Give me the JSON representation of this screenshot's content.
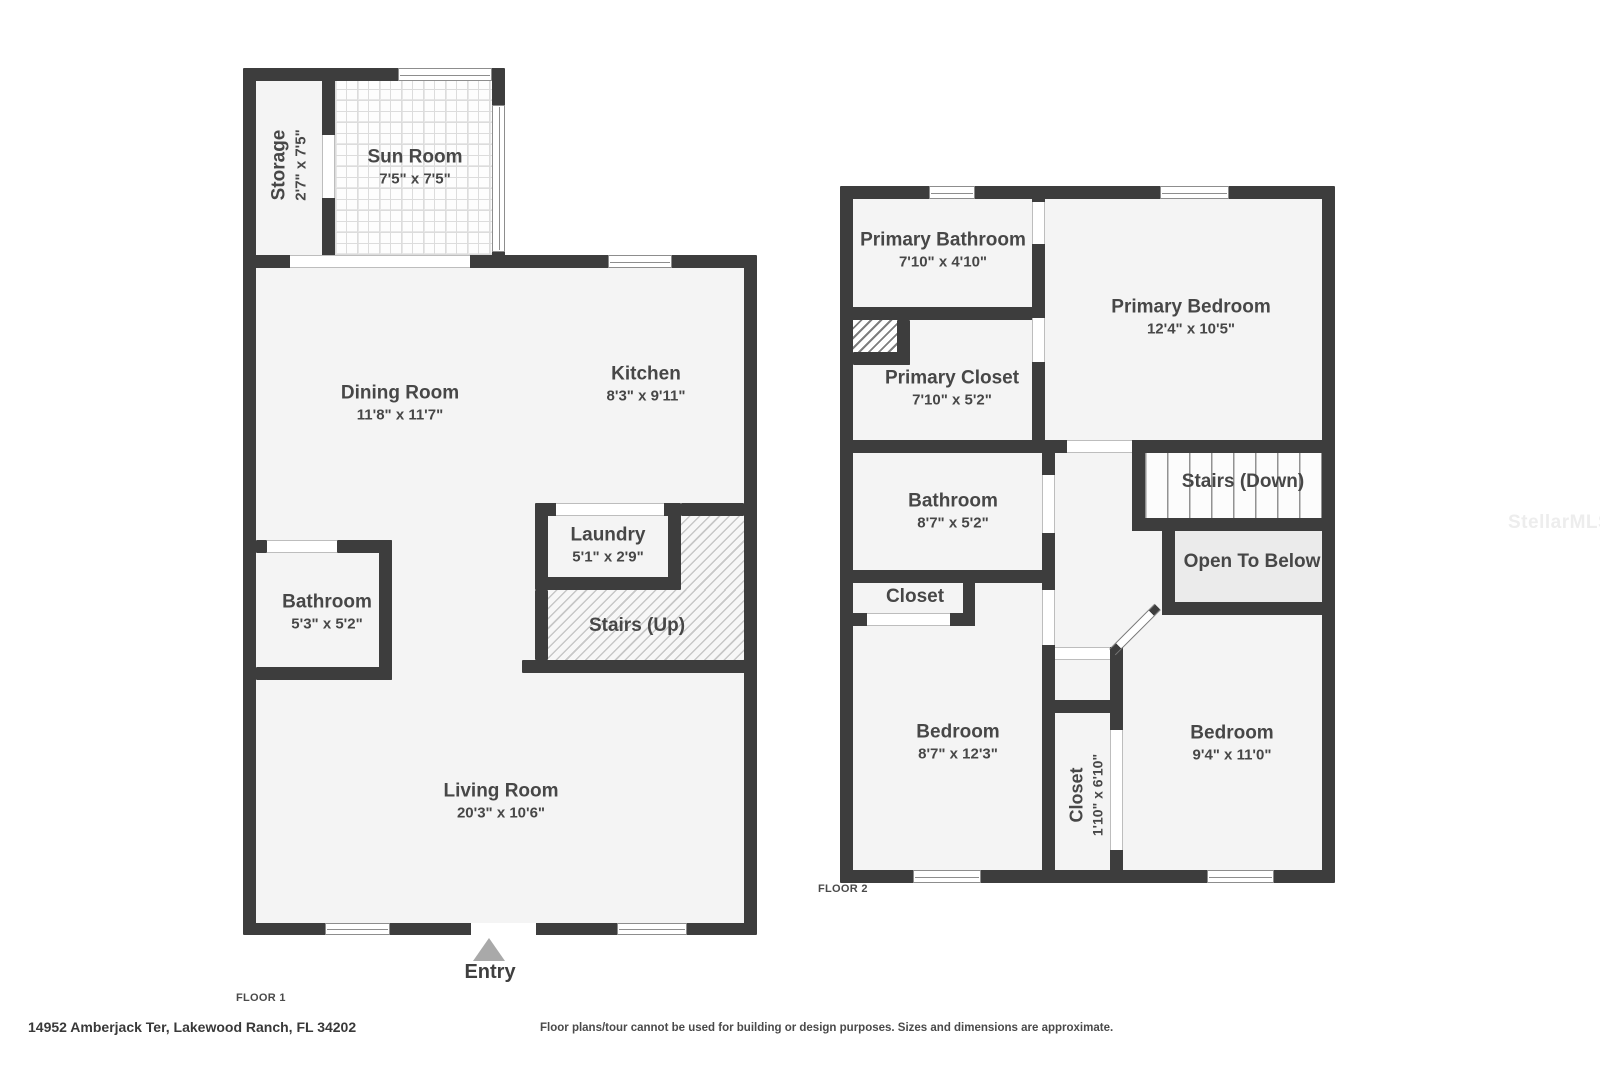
{
  "watermark": "StellarMLS",
  "footer": {
    "address": "14952 Amberjack Ter, Lakewood Ranch, FL 34202",
    "disclaimer": "Floor plans/tour cannot be used for building or design purposes. Sizes and dimensions are approximate."
  },
  "floor1": {
    "label": "FLOOR 1",
    "entry_label": "Entry",
    "rooms": {
      "storage": {
        "name": "Storage",
        "dims": "2'7\" x 7'5\""
      },
      "sun_room": {
        "name": "Sun Room",
        "dims": "7'5\" x 7'5\""
      },
      "dining_room": {
        "name": "Dining Room",
        "dims": "11'8\" x 11'7\""
      },
      "kitchen": {
        "name": "Kitchen",
        "dims": "8'3\" x 9'11\""
      },
      "laundry": {
        "name": "Laundry",
        "dims": "5'1\" x 2'9\""
      },
      "stairs_up": {
        "name": "Stairs (Up)"
      },
      "bathroom": {
        "name": "Bathroom",
        "dims": "5'3\" x 5'2\""
      },
      "living_room": {
        "name": "Living Room",
        "dims": "20'3\" x 10'6\""
      }
    }
  },
  "floor2": {
    "label": "FLOOR 2",
    "rooms": {
      "primary_bathroom": {
        "name": "Primary Bathroom",
        "dims": "7'10\" x 4'10\""
      },
      "primary_closet": {
        "name": "Primary Closet",
        "dims": "7'10\" x 5'2\""
      },
      "primary_bedroom": {
        "name": "Primary Bedroom",
        "dims": "12'4\" x 10'5\""
      },
      "bathroom": {
        "name": "Bathroom",
        "dims": "8'7\" x 5'2\""
      },
      "closet_small": {
        "name": "Closet"
      },
      "stairs_down": {
        "name": "Stairs (Down)"
      },
      "open_to_below": {
        "name": "Open To Below"
      },
      "bedroom_left": {
        "name": "Bedroom",
        "dims": "8'7\" x 12'3\""
      },
      "closet_center": {
        "name": "Closet",
        "dims": "1'10\" x 6'10\""
      },
      "bedroom_right": {
        "name": "Bedroom",
        "dims": "9'4\" x 11'0\""
      }
    }
  }
}
